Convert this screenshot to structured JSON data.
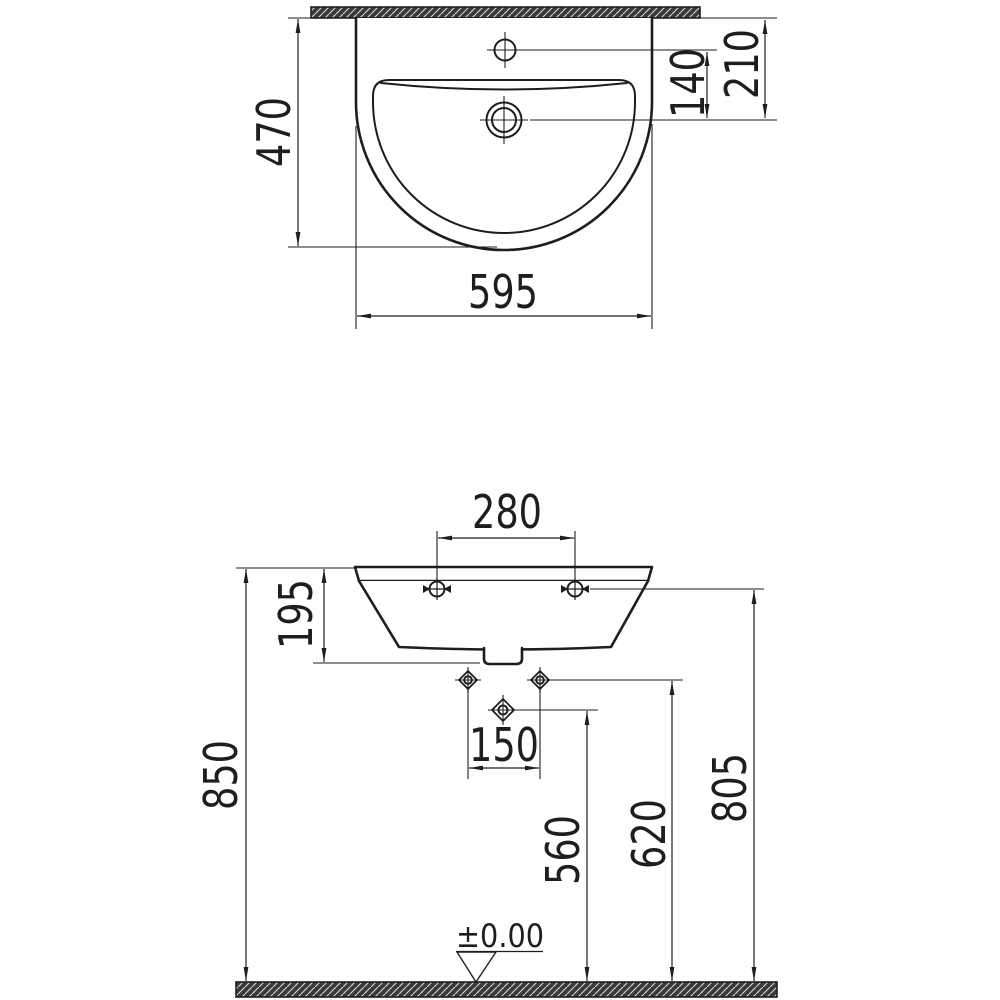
{
  "colors": {
    "line": "#1e1e1e",
    "background": "#ffffff",
    "hatch_fill": "#3a3a3a",
    "hatch_stripe": "#d8d8d8"
  },
  "top_view": {
    "dim_depth": "470",
    "dim_width": "595",
    "dim_tap_hole_offset": "140",
    "dim_drain_offset": "210"
  },
  "front_view": {
    "dim_fixing_hole_spacing": "280",
    "dim_basin_height": "195",
    "dim_rim_height": "850",
    "dim_supply_hole_spacing": "150",
    "dim_drain_height": "560",
    "dim_supply_height": "620",
    "dim_fixing_hole_height": "805",
    "floor_level_label": "±0.00"
  }
}
